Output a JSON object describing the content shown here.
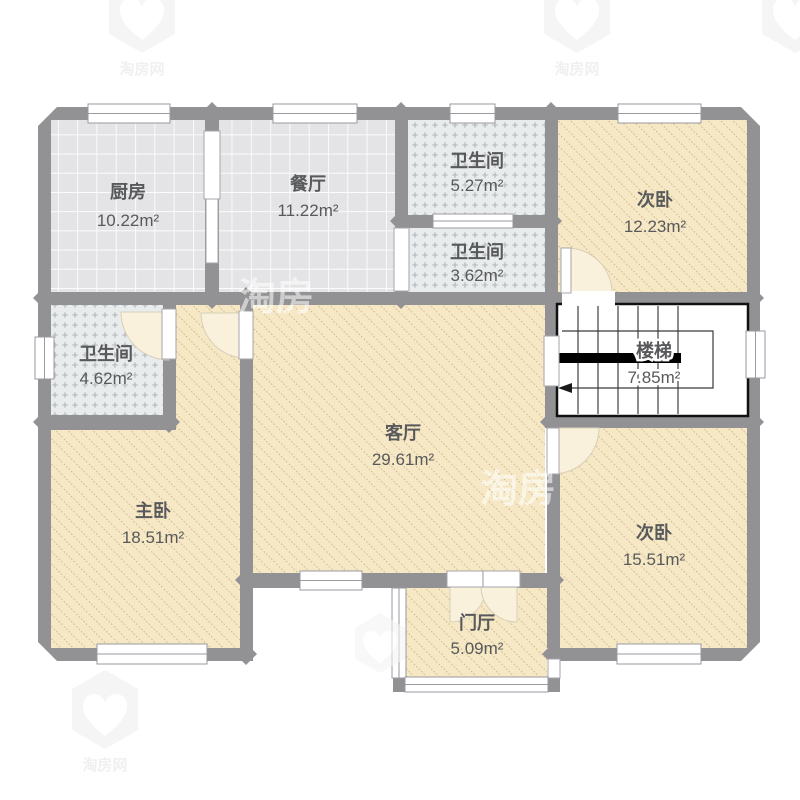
{
  "title": "户型图",
  "unit_suffix": "m²",
  "rooms": [
    {
      "id": "kitchen",
      "name": "厨房",
      "area": "10.22m²"
    },
    {
      "id": "dining",
      "name": "餐厅",
      "area": "11.22m²"
    },
    {
      "id": "bath-top",
      "name": "卫生间",
      "area": "5.27m²"
    },
    {
      "id": "bath-mid",
      "name": "卫生间",
      "area": "3.62m²"
    },
    {
      "id": "bedroom-ne",
      "name": "次卧",
      "area": "12.23m²"
    },
    {
      "id": "bath-left",
      "name": "卫生间",
      "area": "4.62m²"
    },
    {
      "id": "stairs",
      "name": "楼梯",
      "area": "7.85m²"
    },
    {
      "id": "living",
      "name": "客厅",
      "area": "29.61m²"
    },
    {
      "id": "master",
      "name": "主卧",
      "area": "18.51m²"
    },
    {
      "id": "bedroom-se",
      "name": "次卧",
      "area": "15.51m²"
    },
    {
      "id": "hall",
      "name": "门厅",
      "area": "5.09m²"
    }
  ],
  "watermark": {
    "brand": "淘房",
    "brand_full": "淘房网"
  },
  "colors": {
    "wall": "#929295",
    "floor_beige": "#f6e8c5",
    "hatch_line": "#c9b68c",
    "tile_bg": "#e4e4e6",
    "tile_line": "#ffffff",
    "bath_bg": "#e9eced",
    "bath_mark": "#b2b6ba",
    "stairs_border": "#111111",
    "door_swing": "#f9f1dc",
    "window_border": "#9a9aa0",
    "label": "#58595b"
  }
}
